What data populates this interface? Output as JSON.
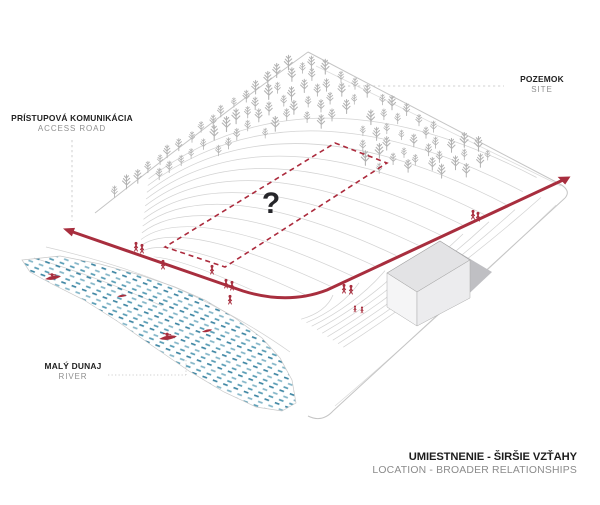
{
  "diagram": {
    "question_mark": "?",
    "labels": {
      "access_road": {
        "primary": "PRÍSTUPOVÁ KOMUNIKÁCIA",
        "secondary": "ACCESS ROAD"
      },
      "site": {
        "primary": "POZEMOK",
        "secondary": "SITE"
      },
      "river": {
        "primary": "MALÝ DUNAJ",
        "secondary": "RIVER"
      }
    },
    "title": {
      "primary": "UMIESTNENIE - ŠIRŠIE VZŤAHY",
      "secondary": "LOCATION - BROADER RELATIONSHIPS"
    },
    "colors": {
      "accent_red": "#a82e3e",
      "tree_gray": "#b3b3b3",
      "contour_gray": "#d3d3d3",
      "river_blue": "#4f92ad",
      "building_gray": "#e3e3e5",
      "label_dark": "#1f1f1f",
      "label_gray": "#8f8f8f"
    }
  }
}
